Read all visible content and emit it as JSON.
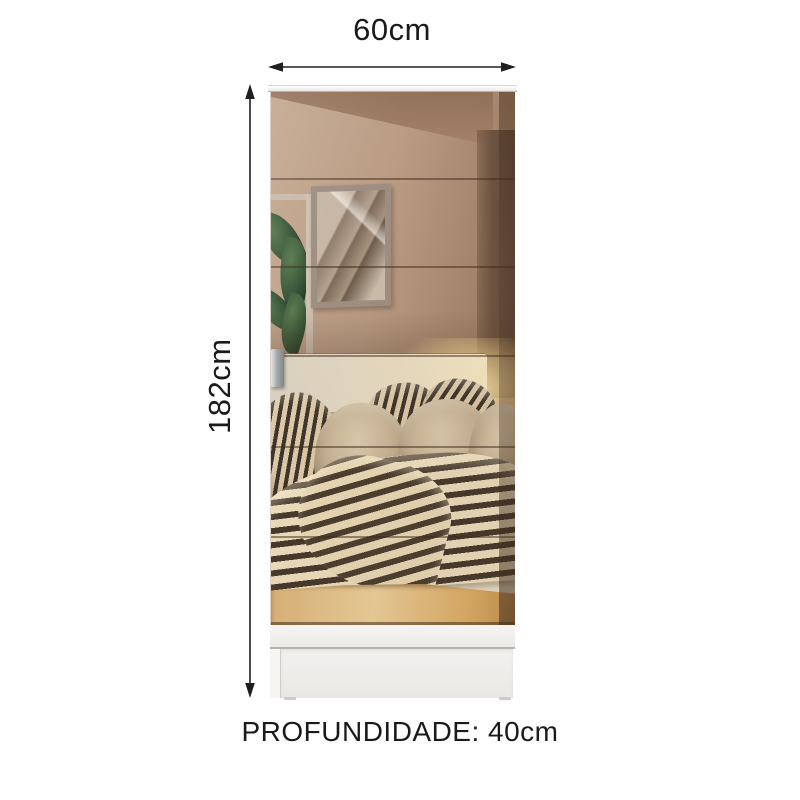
{
  "background_color": "#ffffff",
  "annotations": {
    "width_label": "60cm",
    "height_label": "182cm",
    "depth_label": "PROFUNDIDADE: 40cm",
    "line_color": "#1f1f1f",
    "text_color": "#1a1a1a"
  },
  "wardrobe": {
    "type": "single-door wardrobe with full-length mirror door",
    "body_color": "#f2f1ef",
    "top_panel_color": "#f6f5f3",
    "handle_color": "#9ba0a4",
    "mirror_reflection": {
      "description": "bedroom reflection: backlit cream headboard, beige and dark-striped pillows, striped duvet, framed abstract artwork, green plant, white nightstand, light wood floor",
      "wall_color": "#b3967f",
      "dark_wall_color": "#6d5340",
      "headboard_glow_color": "#ffe9ad",
      "duvet_stripe_dark": "#45392b",
      "duvet_stripe_light": "#ecdcbb",
      "floor_color": "#ddb87b",
      "plant_color": "#2c4a30"
    }
  }
}
